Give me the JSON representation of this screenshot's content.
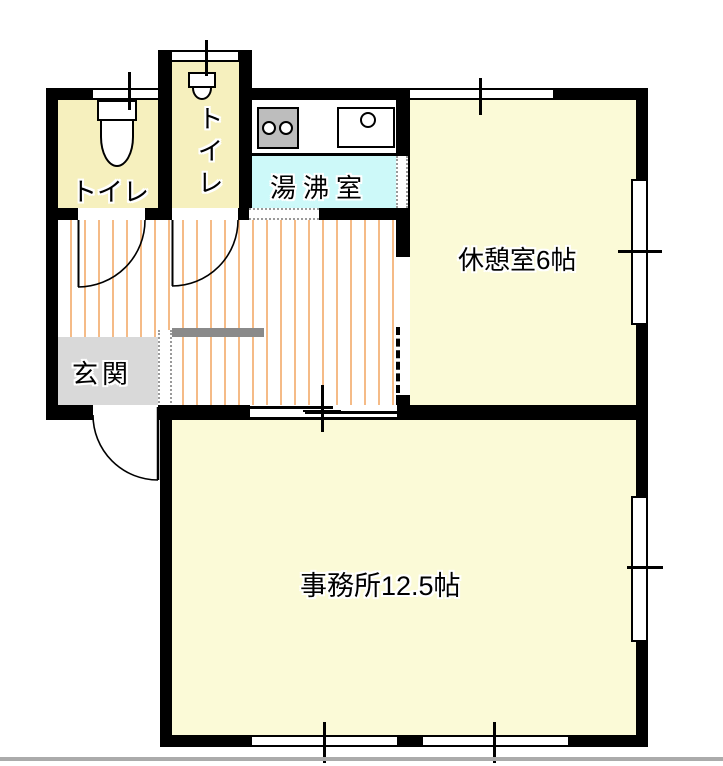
{
  "plan_title": "office floor plan",
  "rooms": {
    "toilet_left": {
      "label": "トイレ"
    },
    "toilet_right": {
      "label": "トイレ"
    },
    "kitchenette": {
      "label": "湯沸室"
    },
    "break_room": {
      "label": "休憩室6帖"
    },
    "entrance": {
      "label": "玄関"
    },
    "office": {
      "label": "事務所12.5帖"
    }
  },
  "colors": {
    "wall": "#000000",
    "room_yellow": "#FBFAD7",
    "toilet_yellow": "#F6F0BE",
    "kitchen_cyan": "#CDF9F9",
    "entrance_gray": "#D9D9D9",
    "step_gray": "#8A8A8A",
    "stove_gray": "#BDBDBD",
    "stripe_orange": "#F5BB87",
    "page_rule_gray": "#ABABAB"
  }
}
